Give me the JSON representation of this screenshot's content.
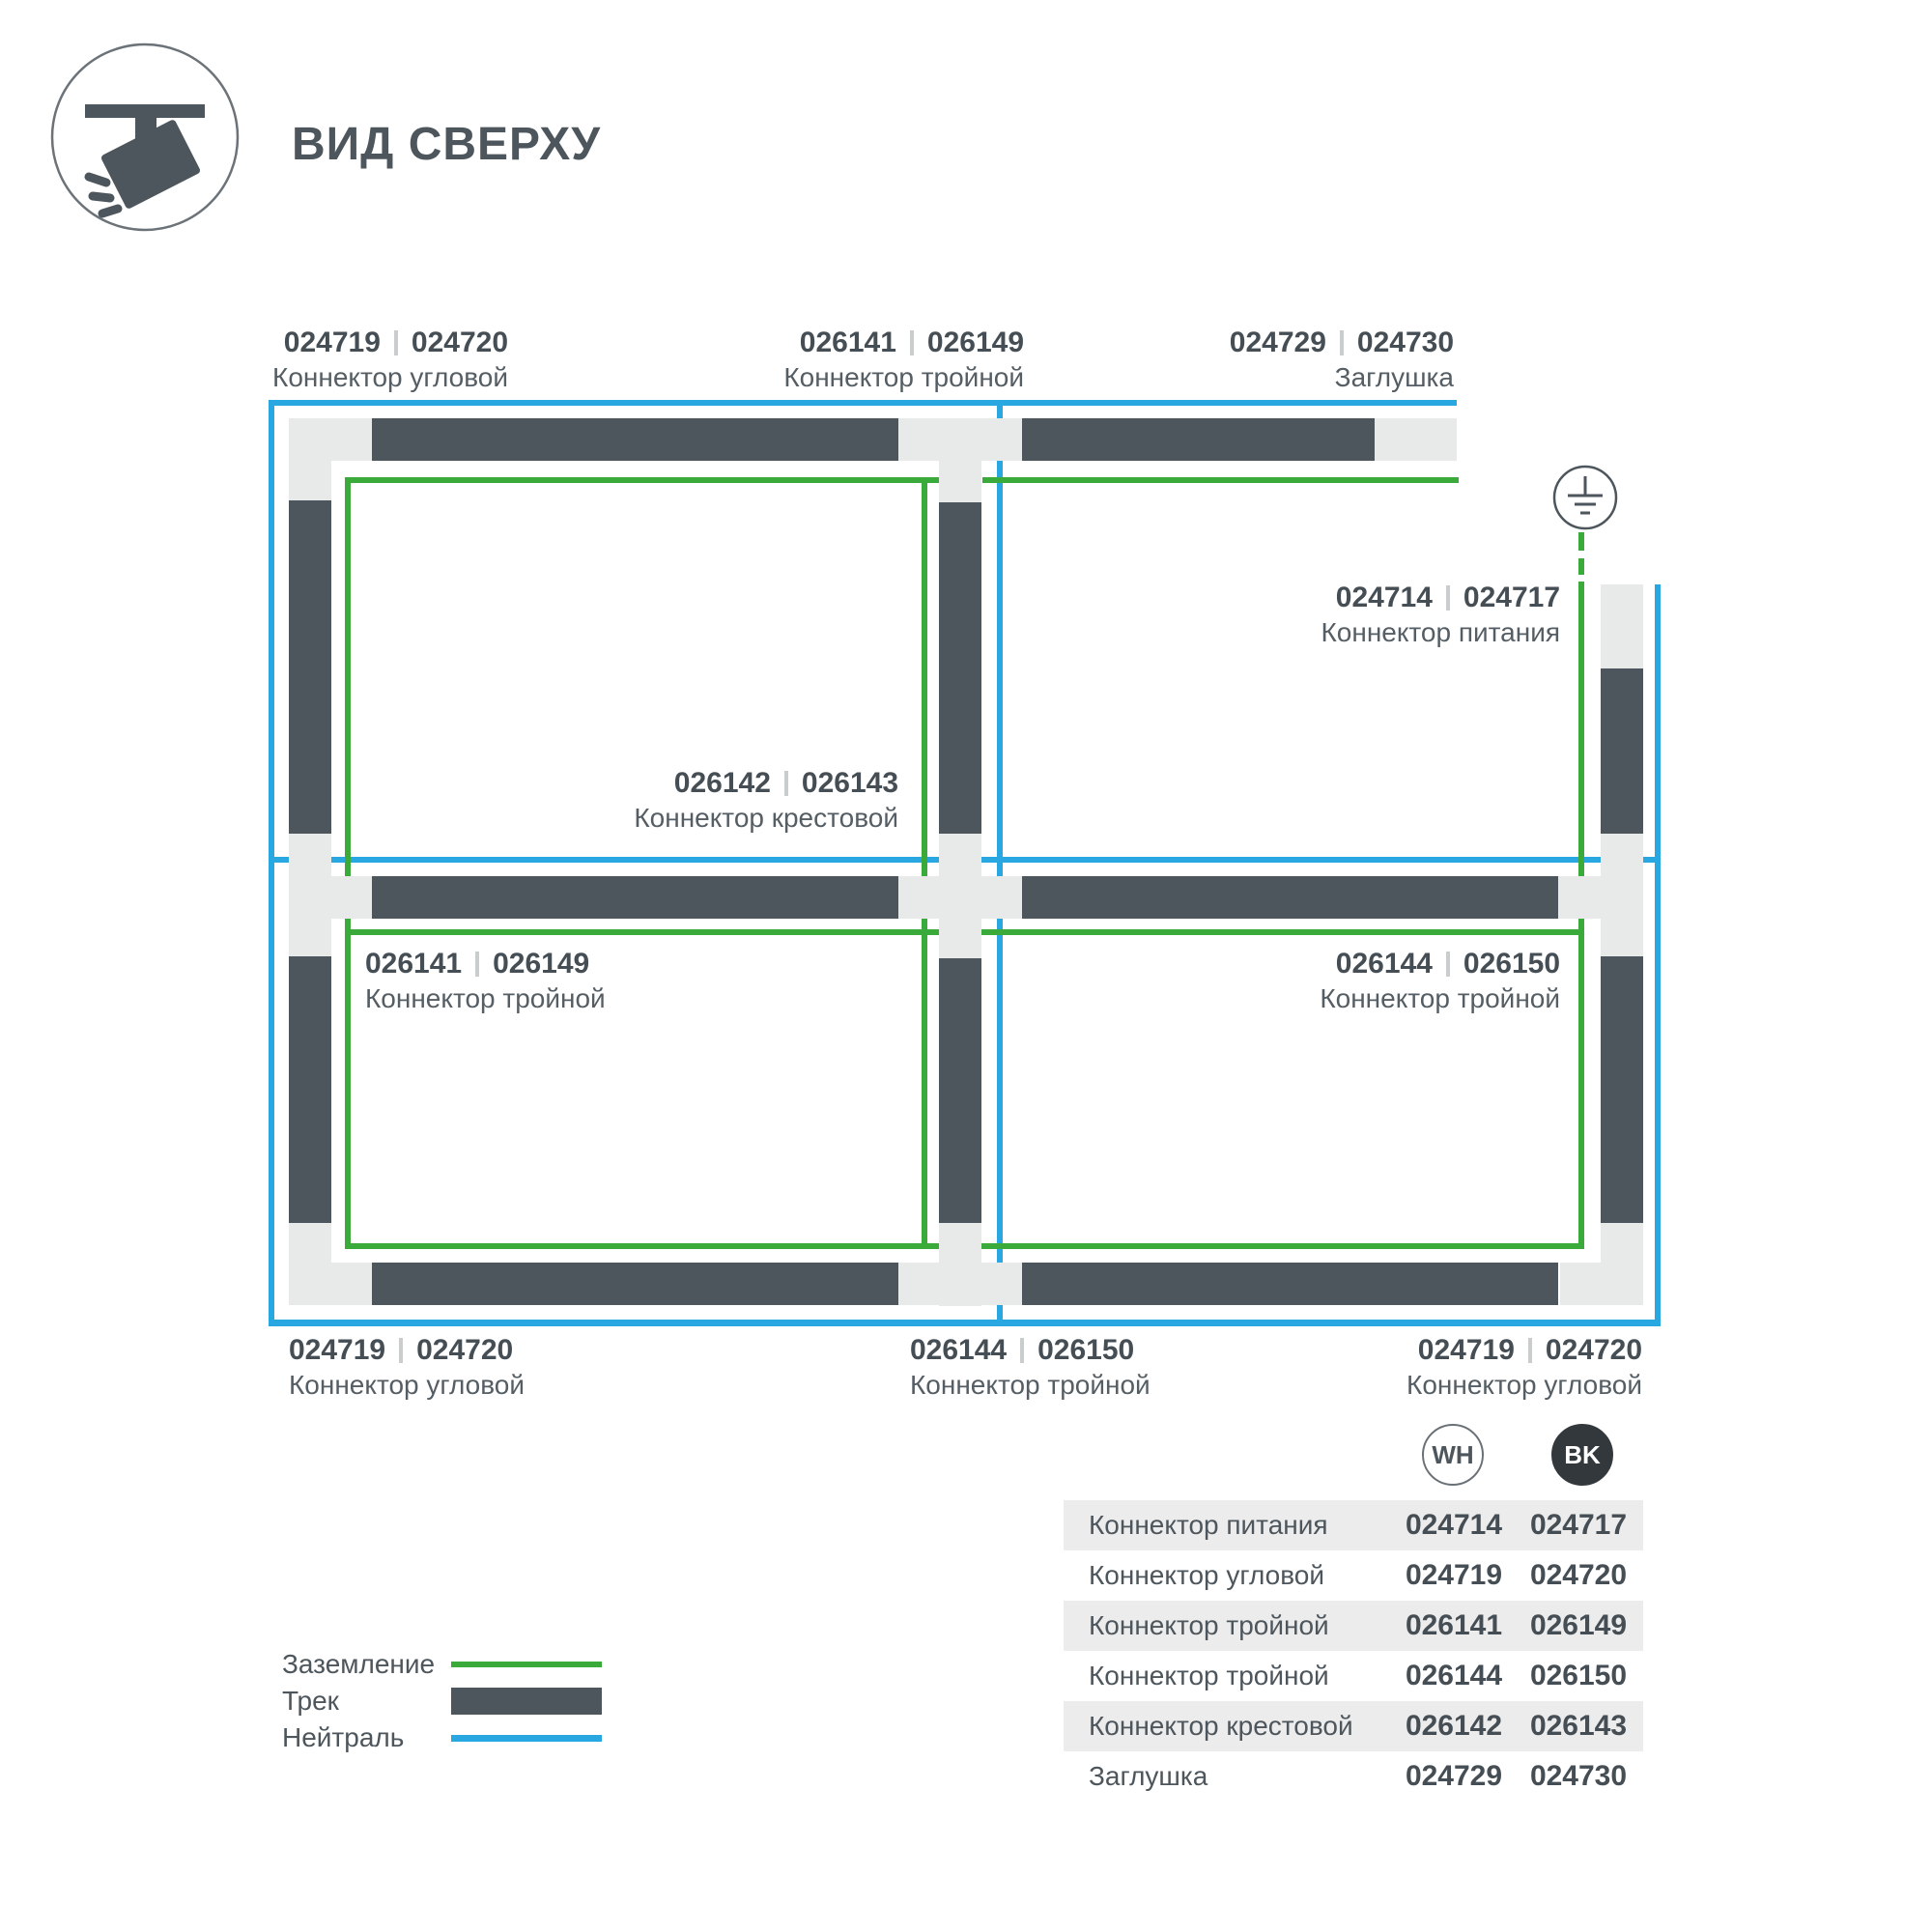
{
  "page": {
    "title": "ВИД СВЕРХУ"
  },
  "colors": {
    "track": "#4D565C",
    "connector": "#E8EAEA",
    "ground_green": "#3AAB3A",
    "neutral_blue": "#29A7E0",
    "table_row_bg": "#ECECEC",
    "badge_bk_bg": "#33383C"
  },
  "diagram": {
    "labels": {
      "top_left": {
        "code_wh": "024719",
        "code_bk": "024720",
        "name": "Коннектор угловой"
      },
      "top_middle": {
        "code_wh": "026141",
        "code_bk": "026149",
        "name": "Коннектор тройной"
      },
      "top_right": {
        "code_wh": "024729",
        "code_bk": "024730",
        "name": "Заглушка"
      },
      "power": {
        "code_wh": "024714",
        "code_bk": "024717",
        "name": "Коннектор питания"
      },
      "cross": {
        "code_wh": "026142",
        "code_bk": "026143",
        "name": "Коннектор крестовой"
      },
      "middle_left": {
        "code_wh": "026141",
        "code_bk": "026149",
        "name": "Коннектор тройной"
      },
      "middle_right": {
        "code_wh": "026144",
        "code_bk": "026150",
        "name": "Коннектор тройной"
      },
      "bottom_left": {
        "code_wh": "024719",
        "code_bk": "024720",
        "name": "Коннектор угловой"
      },
      "bottom_middle": {
        "code_wh": "026144",
        "code_bk": "026150",
        "name": "Коннектор тройной"
      },
      "bottom_right": {
        "code_wh": "024719",
        "code_bk": "024720",
        "name": "Коннектор угловой"
      }
    }
  },
  "legend": {
    "items": [
      {
        "label": "Заземление"
      },
      {
        "label": "Трек"
      },
      {
        "label": "Нейтраль"
      }
    ]
  },
  "table": {
    "columns": {
      "wh": "WH",
      "bk": "BK"
    },
    "rows": [
      {
        "name": "Коннектор питания",
        "wh": "024714",
        "bk": "024717"
      },
      {
        "name": "Коннектор угловой",
        "wh": "024719",
        "bk": "024720"
      },
      {
        "name": "Коннектор тройной",
        "wh": "026141",
        "bk": "026149"
      },
      {
        "name": "Коннектор тройной",
        "wh": "026144",
        "bk": "026150"
      },
      {
        "name": "Коннектор крестовой",
        "wh": "026142",
        "bk": "026143"
      },
      {
        "name": "Заглушка",
        "wh": "024729",
        "bk": "024730"
      }
    ]
  }
}
